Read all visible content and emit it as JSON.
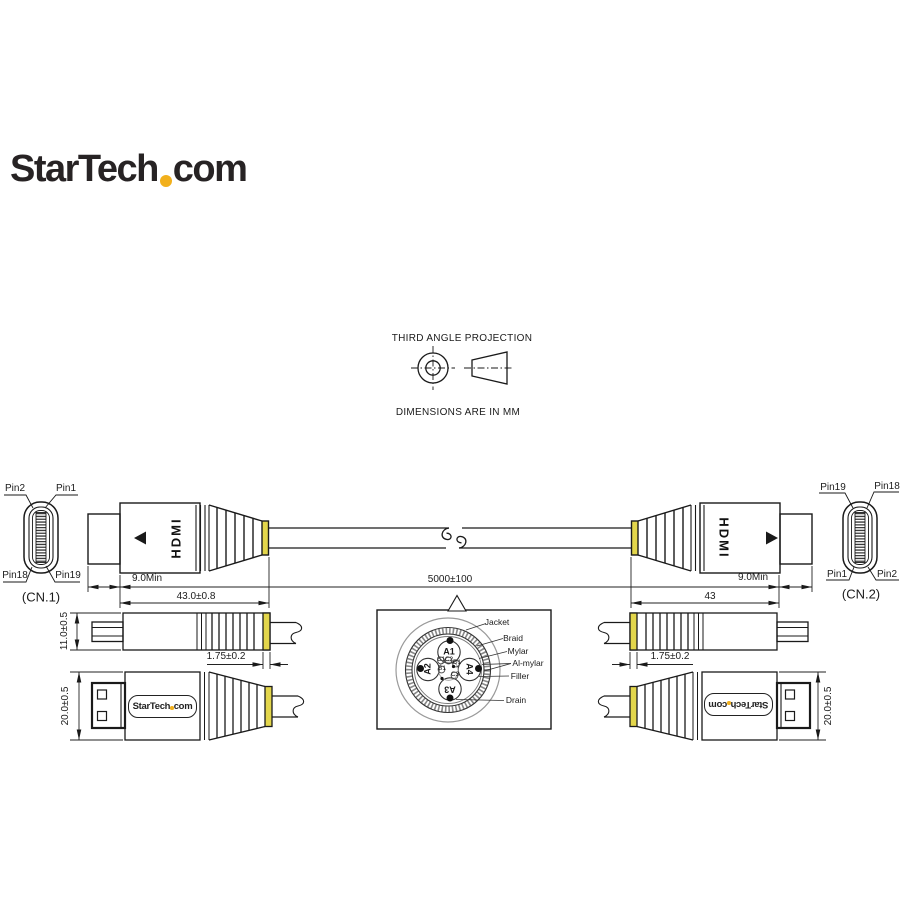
{
  "brand": {
    "name_part1": "StarTech",
    "name_part2": "com",
    "dot_color": "#f2b01c"
  },
  "projection": {
    "title": "THIRD ANGLE PROJECTION",
    "units_note": "DIMENSIONS ARE IN MM"
  },
  "dims": {
    "tip_length": "9.0Min",
    "cable_length": "5000±100",
    "connector_length_tol": "43.0±0.8",
    "connector_length": "43",
    "band_width": "1.75±0.2",
    "connector_height_top_view": "11.0±0.5",
    "connector_height_side_view": "20.0±0.5"
  },
  "connector": {
    "port_text": "HDMI"
  },
  "cn1": {
    "label": "(CN.1)",
    "pin_top_left": "Pin2",
    "pin_top_right": "Pin1",
    "pin_bottom_left": "Pin18",
    "pin_bottom_right": "Pin19"
  },
  "cn2": {
    "label": "(CN.2)",
    "pin_top_left": "Pin19",
    "pin_top_right": "Pin18",
    "pin_bottom_left": "Pin1",
    "pin_bottom_right": "Pin2"
  },
  "cross_section": {
    "layers": [
      "Jacket",
      "Braid",
      "Mylar",
      "Al-mylar",
      "Filler",
      "Drain"
    ],
    "pairs": {
      "a1": "A1",
      "a2": "A2",
      "a3": "A3",
      "a4": "A4"
    },
    "center_wires": {
      "c1": "C1",
      "c2": "C2",
      "c3": "C3",
      "b1": "B1",
      "d1": "D1"
    }
  },
  "colors": {
    "band_yellow": "#e3d64b",
    "line": "#1a1a1a"
  }
}
